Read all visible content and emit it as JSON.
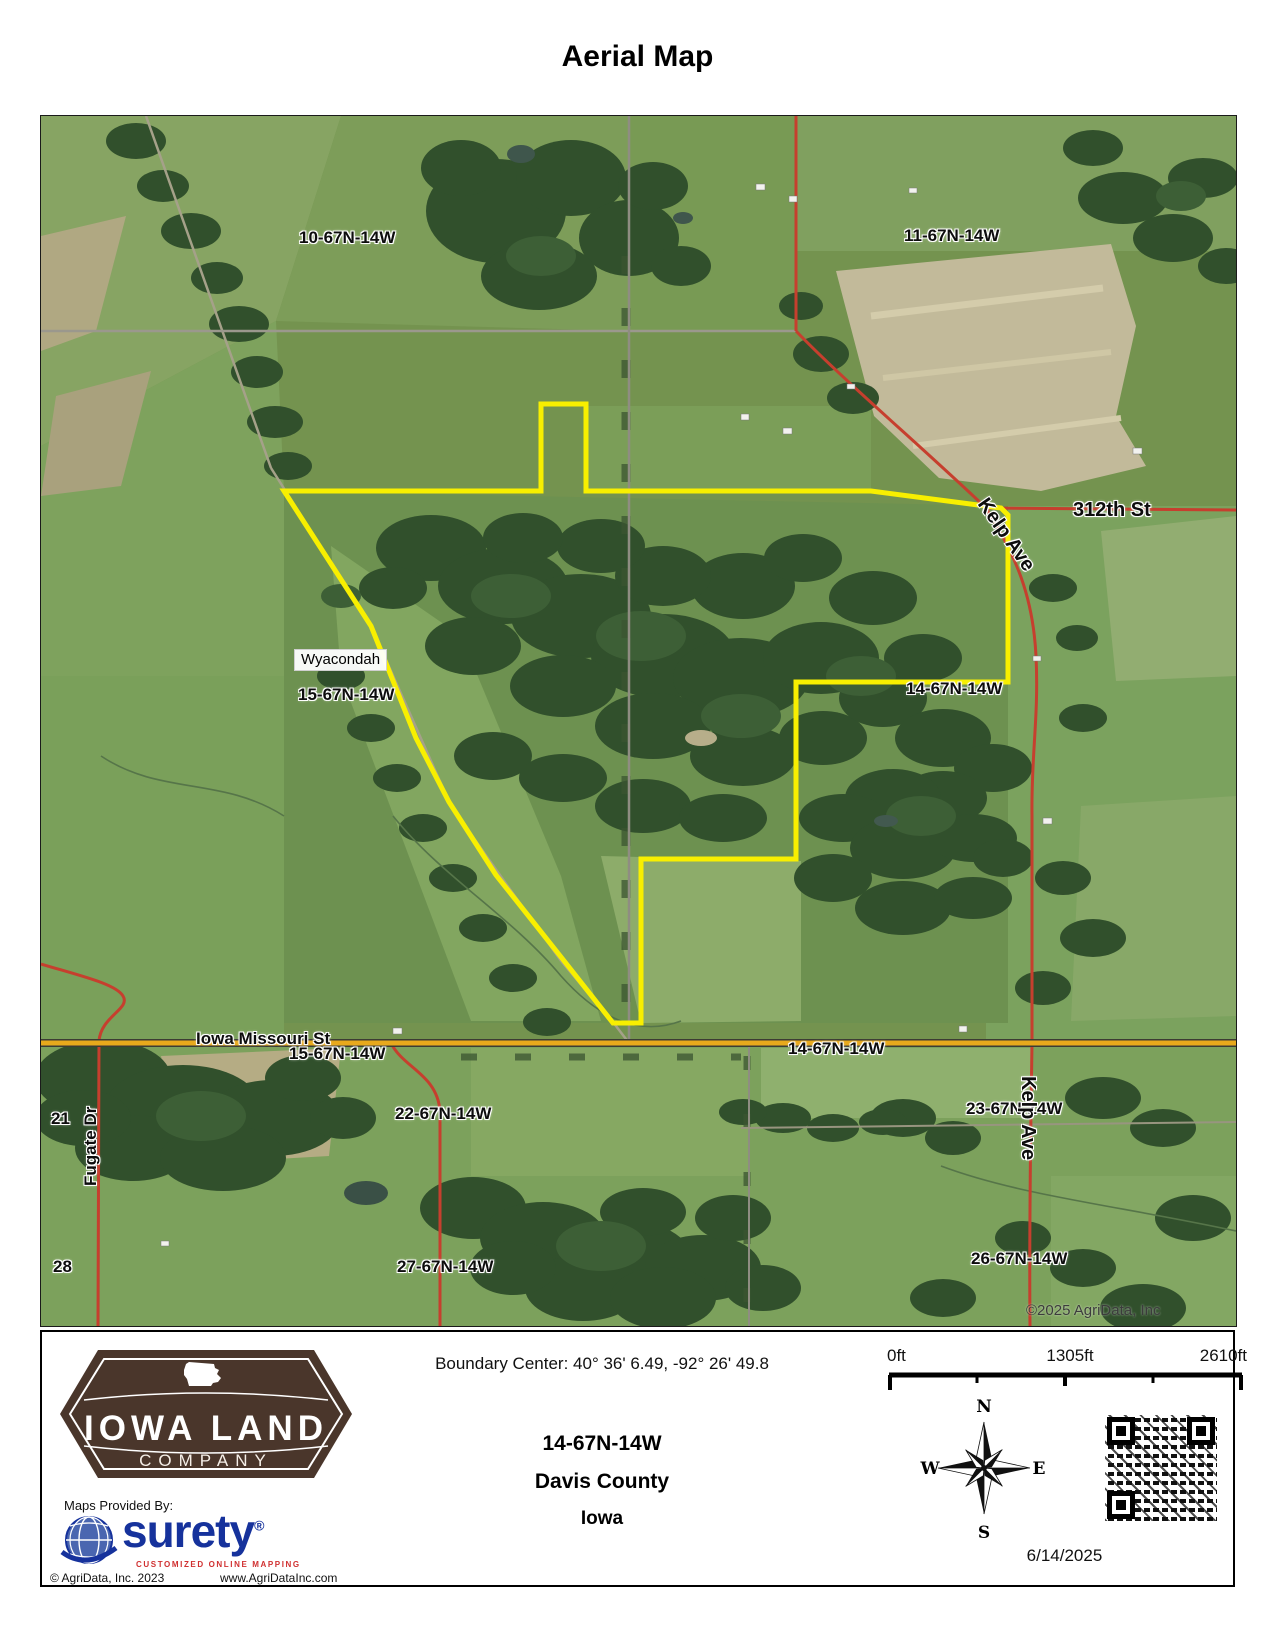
{
  "title": "Aerial Map",
  "map": {
    "boundary_color": "#f8ef00",
    "labels": {
      "sec10": "10-67N-14W",
      "sec11": "11-67N-14W",
      "street_312": "312th St",
      "kelp_ave_top": "Kelp Ave",
      "wyacondah": "Wyacondah",
      "sec15_upper": "15-67N-14W",
      "sec14_mid": "14-67N-14W",
      "iowa_missouri": "Iowa Missouri St",
      "sec15_road": "15-67N-14W",
      "sec14_road": "14-67N-14W",
      "sec21": "21",
      "fugate_dr": "Fugate Dr",
      "sec28": "28",
      "sec22": "22-67N-14W",
      "sec23": "23-67N-14W",
      "sec27": "27-67N-14W",
      "sec26": "26-67N-14W",
      "kelp_ave_bottom": "Kelp Ave",
      "copyright": "©2025 AgriData, Inc"
    }
  },
  "footer": {
    "boundary_center": "Boundary Center: 40° 36' 6.49,  -92° 26' 49.8",
    "township": "14-67N-14W",
    "county": "Davis County",
    "state": "Iowa",
    "scale": {
      "t0": "0ft",
      "t1": "1305ft",
      "t2": "2610ft"
    },
    "compass": {
      "n": "N",
      "e": "E",
      "s": "S",
      "w": "W"
    },
    "date": "6/14/2025",
    "logo": {
      "line1": "IOWA LAND",
      "line2": "COMPANY"
    },
    "provider": {
      "heading": "Maps Provided By:",
      "name": "surety",
      "reg": "®",
      "tagline": "CUSTOMIZED ONLINE MAPPING"
    },
    "copyright": "© AgriData, Inc. 2023",
    "website": "www.AgriDataInc.com"
  }
}
